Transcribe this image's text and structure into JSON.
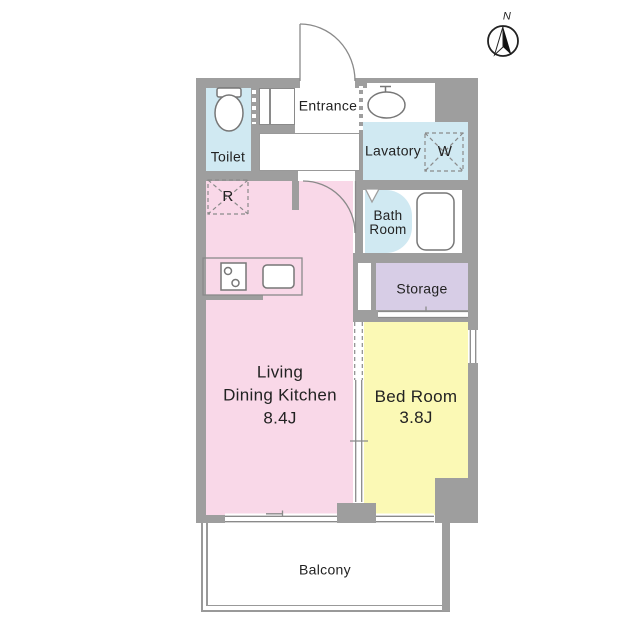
{
  "compass": {
    "label": "N"
  },
  "rooms": {
    "toilet": {
      "label": "Toilet"
    },
    "entrance": {
      "label": "Entrance"
    },
    "lavatory": {
      "label": "Lavatory"
    },
    "bath": {
      "label": "Bath\nRoom"
    },
    "storage": {
      "label": "Storage"
    },
    "ldk": {
      "label": "Living\nDining Kitchen\n8.4J"
    },
    "bedroom": {
      "label": "Bed Room\n3.8J"
    },
    "balcony": {
      "label": "Balcony"
    }
  },
  "appliances": {
    "washer": {
      "label": "W"
    },
    "refrigerator": {
      "label": "R"
    }
  },
  "colors": {
    "wall": "#9e9e9e",
    "water": "#d0e9f2",
    "pink": "#f9d8e8",
    "yellow": "#fbf9b5",
    "purple": "#d7cde6",
    "line": "#8a8a8a",
    "fixture": "#777777",
    "rail": "#999999",
    "text": "#222222"
  }
}
